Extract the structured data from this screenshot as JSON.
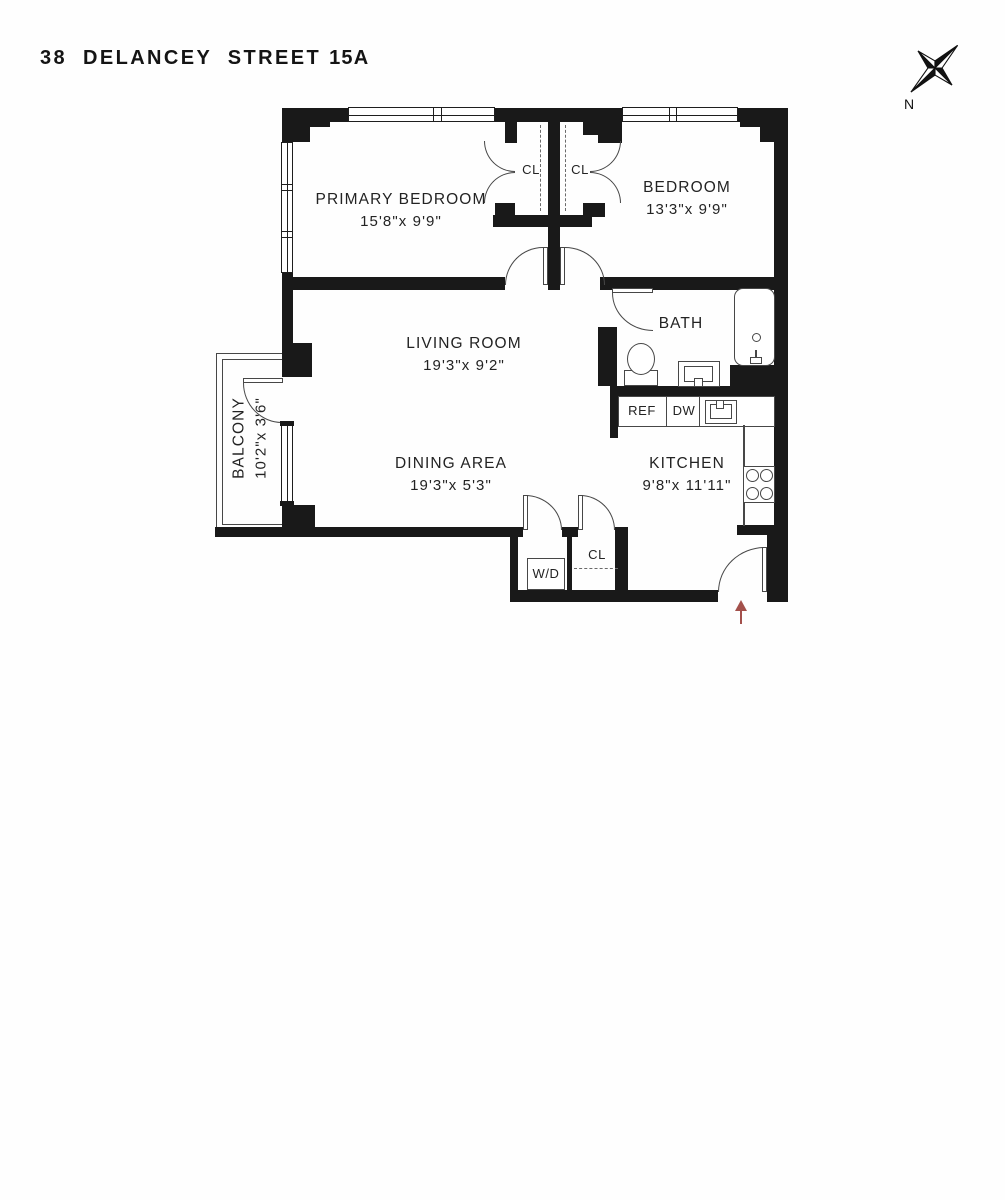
{
  "title": {
    "address": "38 DELANCEY STREET",
    "unit": "15A"
  },
  "compass": {
    "north_label": "N"
  },
  "rooms": {
    "primary_bedroom": {
      "name": "PRIMARY BEDROOM",
      "dimensions": "15'8\"x 9'9\""
    },
    "bedroom": {
      "name": "BEDROOM",
      "dimensions": "13'3\"x 9'9\""
    },
    "living_room": {
      "name": "LIVING ROOM",
      "dimensions": "19'3\"x 9'2\""
    },
    "dining_area": {
      "name": "DINING AREA",
      "dimensions": "19'3\"x 5'3\""
    },
    "kitchen": {
      "name": "KITCHEN",
      "dimensions": "9'8\"x 11'11\""
    },
    "bath": {
      "name": "BATH"
    },
    "balcony": {
      "name": "BALCONY",
      "dimensions": "10'2\"x 3'6\""
    }
  },
  "labels": {
    "closet_primary": "CL",
    "closet_bedroom": "CL",
    "closet_hall": "CL",
    "washer_dryer": "W/D",
    "refrigerator": "REF",
    "dishwasher": "DW"
  },
  "colors": {
    "wall": "#191919",
    "entry_arrow": "#a3504b"
  }
}
